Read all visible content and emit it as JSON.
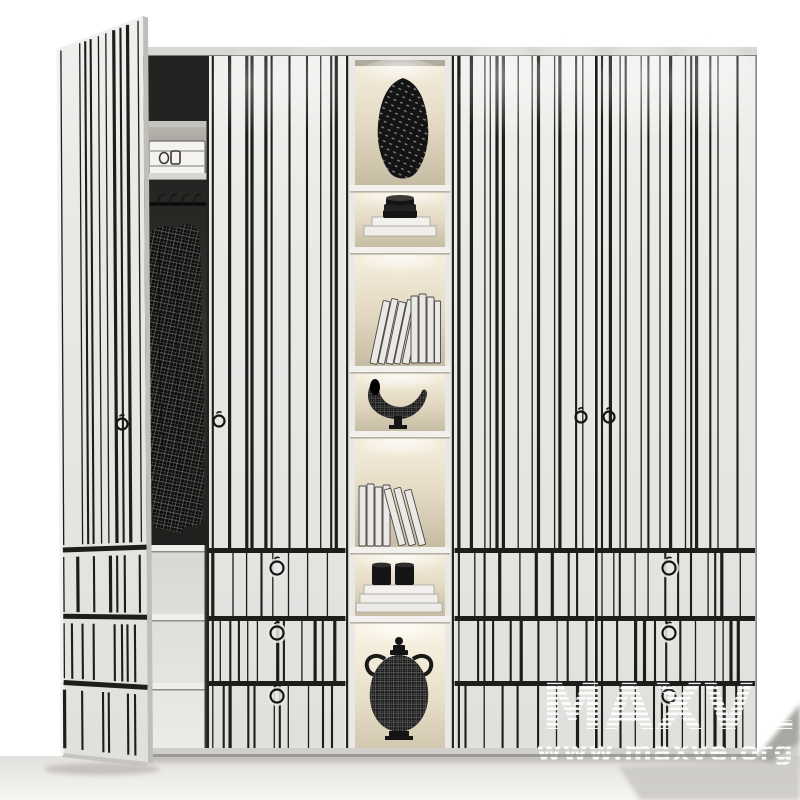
{
  "watermark": {
    "brand": "MAXVE",
    "url": "www.maxve.org"
  },
  "scene": {
    "type": "3d-furniture-render",
    "subject": "white striped wardrobe with one open door, lit display shelf column and drawer fronts",
    "colors": {
      "body": "#e9e8e5",
      "stripes": "#1d1d1b",
      "cap": "#d9d8d5",
      "interior": "#232321",
      "item": "#141414",
      "shelf-light": "#f5eedd",
      "shelf-shade": "#c9bfa6",
      "floor": "#eceae6",
      "shadow": "#aaa8a3",
      "watermark": "#ffffff"
    },
    "counts": {
      "door_panels": 4,
      "display_shelves": 7,
      "drawer_rows": 3,
      "ring_handles": 4,
      "drawer_knobs": 6
    },
    "objects": [
      "open-door",
      "hanging-clothes",
      "storage-box",
      "perforated-vase",
      "bowl-stack-on-books",
      "leaning-books",
      "woven-horn-sculpture",
      "standing-books",
      "black-jars-on-books",
      "woven-lidded-urn"
    ]
  }
}
